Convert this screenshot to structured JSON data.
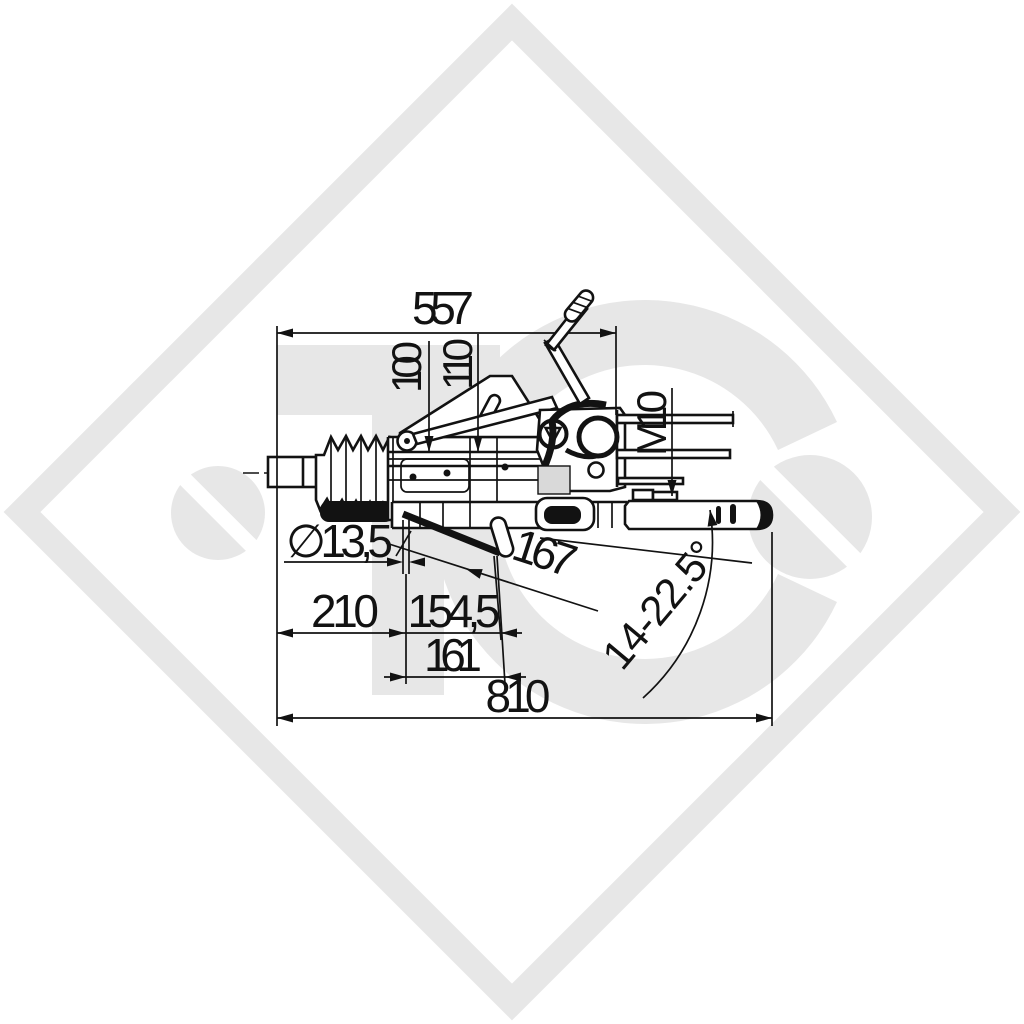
{
  "page": {
    "background_color": "#ffffff",
    "line_color": "#121212",
    "watermark_color": "#e7e7e7",
    "shaded_block_color": "#d9d9d9"
  },
  "watermark": {
    "letter_t": "T",
    "letter_c": "C",
    "description": "light gray diamond border with TC logo and slashed-circle marks"
  },
  "drawing": {
    "subject": "overrun brake coupling / drawbar side view technical drawing",
    "labels": {
      "dim_top_length": "557",
      "dim_height_100": "100",
      "dim_height_110": "110",
      "thread_size": "M10",
      "hole_diameter": "∅13,5",
      "dim_167": "167",
      "dim_210": "210",
      "dim_154_5": "154,5",
      "dim_161": "161",
      "dim_overall_length": "810",
      "angle_range": "14-22.5°"
    }
  }
}
